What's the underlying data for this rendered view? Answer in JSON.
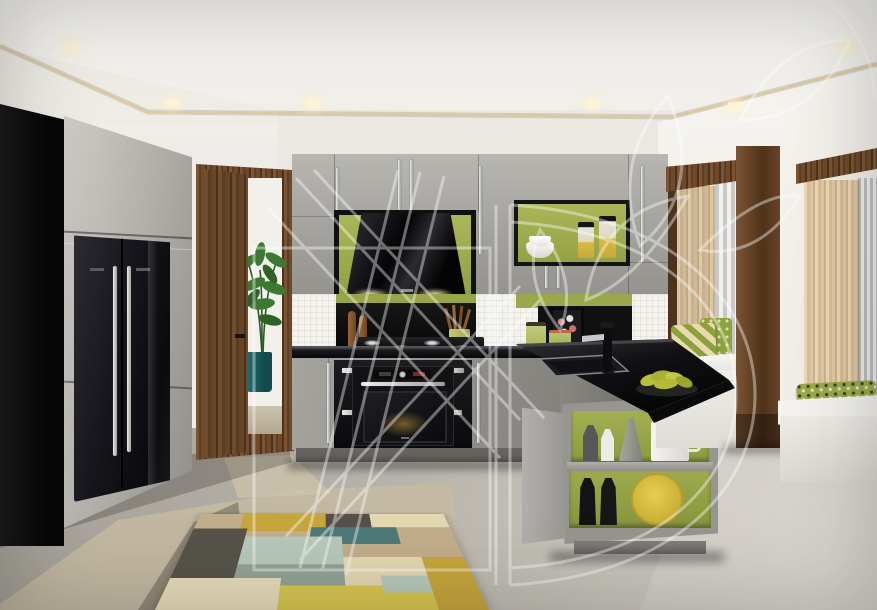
{
  "meta": {
    "domain": "Natural-Image",
    "subject": "3D interior render of a modern open-plan kitchen",
    "visible_text": "none",
    "watermark": "large translucent white monogram with diagonal stripes, rounded letter and leaf motifs overlaid across the image"
  },
  "palette": {
    "cabinet_grey": "#a6a4a0",
    "accent_olive_green": "#9fab4e",
    "counter_black": "#101113",
    "walnut_wood": "#6b4629",
    "wall_white": "#f0eee9",
    "floor_concrete": "#b7b3aa",
    "fridge_black": "#141318",
    "rug_mustard": "#c7a63c",
    "rug_teal": "#4d7a78",
    "cushion_green": "#8ea33f",
    "cove_light": "#d9c9a4",
    "plate_yellow": "#d8c23c"
  },
  "scene": {
    "ceiling": {
      "label": "white drop ceiling with recessed spotlights and warm LED cove line",
      "spotlights": 6
    },
    "left_wall": {
      "tall_cabinets": "high-gloss grey floor-to-ceiling cabinet wall with dark end panel",
      "fridge": "black double-door fridge-freezer with long vertical steel handles"
    },
    "doorway": {
      "door": "open walnut door",
      "view": "hallway with tall potted plant in a teal planter"
    },
    "kitchen_run": {
      "upper_cabinets": "grey gloss wall units with slim steel handles",
      "hood": "angled black-glass extractor hood on olive-green feature panel with under-lighting",
      "open_shelf": "open niche with stacked white bowls and two glass storage jars",
      "backsplash": "white mosaic tile with black glass splash panels and olive-green bands",
      "hob": "black gas hob with chrome burners, wooden pepper mills and a utensil pot",
      "oven": "built-in black compact oven with steel handle in black housing",
      "worktop": "polished black stone worktop"
    },
    "peninsula": {
      "sink": "undermount sink with tall black mixer tap",
      "fruit": "dark dish with green bananas and pears",
      "shelf_unit": "open grey peninsula unit, olive-green back panels; grey and white vases, jug, two black bottles and a yellow platter"
    },
    "right_wall": {
      "window_seats": "two window bays with walnut frames, sheer woven curtains, white bench seats and green patterned cushions",
      "view": "pale city skyline"
    },
    "floor": {
      "material": "polished concrete with warm light patches",
      "rug": "geometric patchwork rug in mustard, teal, mint, tan, cream and charcoal"
    }
  },
  "labels": {
    "stage": "rendered photograph of a modern kitchen, no interactive elements",
    "ceiling": "ceiling with spotlights",
    "fridge": "black fridge freezer",
    "doorway": "open walnut door to hallway",
    "hood": "black angled cooker hood",
    "oven": "built-in black oven",
    "hob": "gas hob",
    "sink": "sink and black tap",
    "shelf_unit": "peninsula shelf unit",
    "window_seat_left": "window seat with chevron cushions",
    "window_seat_right": "window seat with patterned cushion",
    "rug": "geometric rug",
    "watermark": "translucent studio watermark"
  }
}
